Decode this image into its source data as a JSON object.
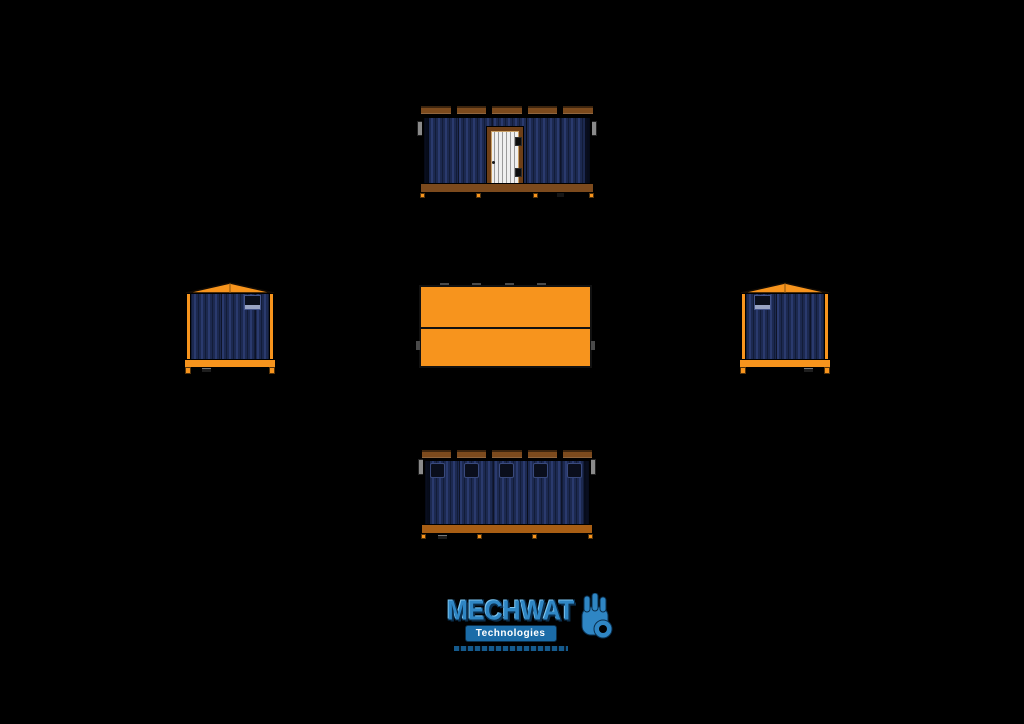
{
  "drawing": {
    "description": "Technical drawing of a portable site office container in five orthographic views",
    "views": {
      "front": {
        "name": "Front elevation with door",
        "roof_rail_segments": 5,
        "door_hinges": 2,
        "feet": 4
      },
      "left": {
        "name": "Left side elevation",
        "vent_position": "top-right",
        "feet": 2
      },
      "right": {
        "name": "Right side elevation",
        "vent_position": "top-left",
        "feet": 2
      },
      "plan": {
        "name": "Roof plan view",
        "panels": 2,
        "top_tabs": 4,
        "side_tabs": 2
      },
      "rear": {
        "name": "Rear elevation with windows",
        "roof_rail_segments": 5,
        "windows": 5,
        "feet": 4
      }
    }
  },
  "logo": {
    "brand": "MECHWAT",
    "subtitle": "Technologies",
    "icon": "ok-hand-icon"
  },
  "colors": {
    "background": "#000000",
    "orange": "#F7941D",
    "brown_rail": "#7C4A1D",
    "rail_orange_brown": "#A85E14",
    "door_frame": "#6E3F17",
    "door_slat": "#EFEFEF",
    "siding_base": "#1C2950",
    "siding_light": "#2A3A6E",
    "siding_dark": "#121C38",
    "window_fill": "#0A0E1C",
    "tab_gray": "#8A8A8A",
    "plan_tab_gray": "#4A4A4A",
    "logo_blue": "#2F86C4",
    "logo_blue_dark": "#0A2F4E",
    "logo_box_blue": "#1B6CA8",
    "logo_highlight": "#7CC4EF"
  }
}
